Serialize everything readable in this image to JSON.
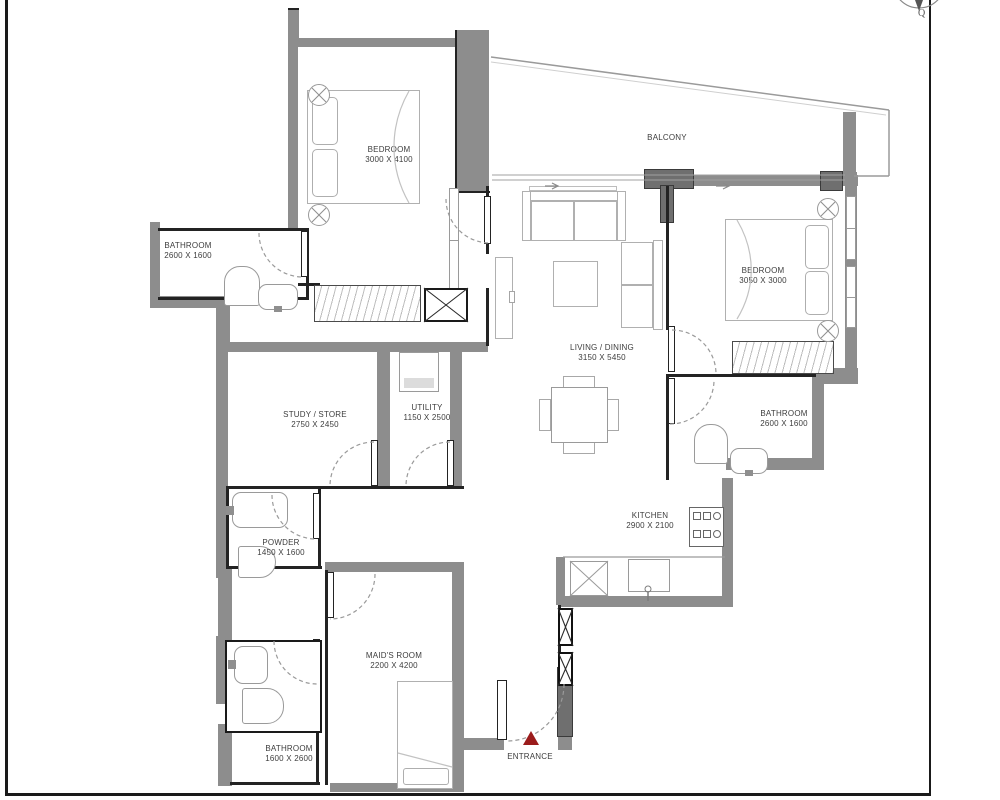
{
  "plan": {
    "compass_label": "Q",
    "rooms": {
      "bedroom1": {
        "name": "BEDROOM",
        "dims": "3000 X 4100"
      },
      "balcony": {
        "name": "BALCONY",
        "dims": ""
      },
      "bedroom2": {
        "name": "BEDROOM",
        "dims": "3050 X 3000"
      },
      "bathroom1": {
        "name": "BATHROOM",
        "dims": "2600 X 1600"
      },
      "living": {
        "name": "LIVING / DINING",
        "dims": "3150 X 5450"
      },
      "study": {
        "name": "STUDY / STORE",
        "dims": "2750 X 2450"
      },
      "utility": {
        "name": "UTILITY",
        "dims": "1150 X 2500"
      },
      "bathroom2": {
        "name": "BATHROOM",
        "dims": "2600 X 1600"
      },
      "powder": {
        "name": "POWDER",
        "dims": "1450 X 1600"
      },
      "kitchen": {
        "name": "KITCHEN",
        "dims": "2900 X 2100"
      },
      "maids_room": {
        "name": "MAID'S ROOM",
        "dims": "2200 X 4200"
      },
      "bathroom3": {
        "name": "BATHROOM",
        "dims": "1600 X 2600"
      },
      "entrance": {
        "name": "ENTRANCE",
        "dims": ""
      }
    },
    "colors": {
      "wall": "#8d8d8d",
      "wall_dark": "#6f6f6f",
      "line": "#232323",
      "furniture_outline": "#b0b0b0",
      "fixture_outline": "#9a9a9a",
      "label_text": "#3d3d3d",
      "entrance_marker": "#9b1c1c",
      "frame": "#1a1a1a"
    }
  }
}
